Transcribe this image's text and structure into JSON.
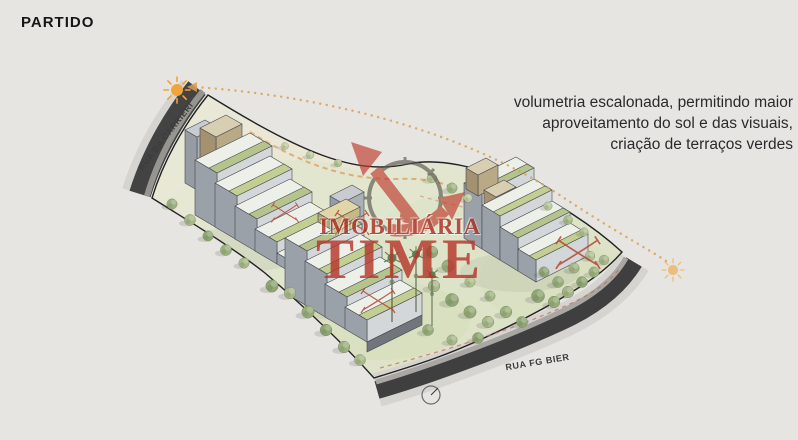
{
  "page": {
    "title": "PARTIDO",
    "background": "#e7e5e2"
  },
  "annotation": {
    "line1": "volumetria escalonada, permitindo maior",
    "line2": "aproveitamento do sol e das visuais,",
    "line3": "criação de terraços verdes"
  },
  "roads": {
    "left_label": "RUA DA CARRIERI",
    "bottom_label": "RUA FG BIER"
  },
  "watermark": {
    "brand_line1": "IMOBILIÁRIA",
    "brand_line2": "TIME"
  },
  "icons": {
    "sun_left": "sun-icon",
    "sun_right": "sun-icon",
    "north_arrow": "north-arrow-icon",
    "compass_logo": "compass-arrows-icon"
  },
  "colors": {
    "background": "#e7e5e2",
    "watermark_red": "#b5372b",
    "sun_orange": "#efa43c",
    "road_dark": "#3f3f3f",
    "tree_green": "#9cb07e",
    "terrace_green": "#b4c48c",
    "dashed_orange": "#de9d60"
  }
}
